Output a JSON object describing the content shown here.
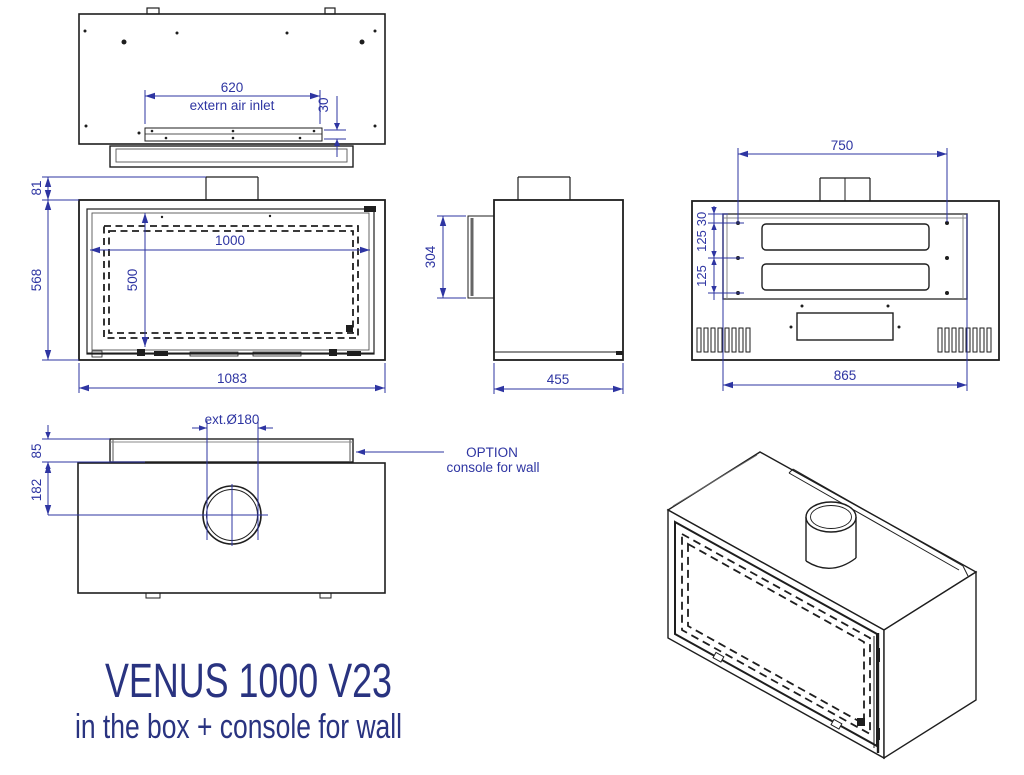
{
  "title": {
    "main": "VENUS 1000 V23",
    "sub": "in the box + console for wall"
  },
  "colors": {
    "dimension_blue": "#2e35a2",
    "drawing_black": "#1e1e1e",
    "title_navy": "#293380"
  },
  "views": {
    "top": {
      "dim_inlet_width": "620",
      "inlet_label": "extern air inlet",
      "dim_inlet_depth": "30"
    },
    "front": {
      "dim_flue_height": "81",
      "dim_height": "568",
      "dim_glass_width": "1000",
      "dim_glass_height": "500",
      "dim_width": "1083"
    },
    "side": {
      "dim_frame_height": "304",
      "dim_depth": "455"
    },
    "rear": {
      "dim_mount_width": "750",
      "dim_hole_top": "30",
      "dim_hole_mid": "125",
      "dim_hole_bottom": "125",
      "dim_body_width": "865"
    },
    "console": {
      "dim_flue": "ext.Ø180",
      "dim_console_depth": "85",
      "dim_flue_offset": "182",
      "option_line1": "OPTION",
      "option_line2": "console for wall"
    }
  }
}
